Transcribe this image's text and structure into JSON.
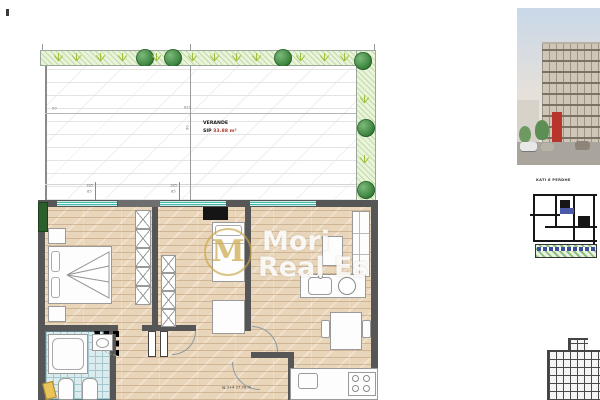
{
  "plan": {
    "veranda": {
      "name": "VERANDE",
      "area_label": "SIP",
      "area_value": "33.88",
      "area_unit": "m²"
    },
    "dimensions": {
      "top_width": "621",
      "top_left": "50",
      "height_mark": "90"
    },
    "window_marks": [
      {
        "top": "185",
        "bottom": "85"
      },
      {
        "top": "185",
        "bottom": "85"
      }
    ],
    "room_note": "lg.3+4 27.76 m",
    "watermark": {
      "monogram": "M",
      "line1": "Mori",
      "line2": "Real Es"
    }
  },
  "side": {
    "floor_caption": "KATI 6 PERDHE"
  },
  "colors": {
    "area_red": "#b03a2e",
    "window_teal": "#49b8a8",
    "plant_green": "#2f7a33",
    "watermark_gold": "#c9a646",
    "wall_gray": "#565656"
  }
}
